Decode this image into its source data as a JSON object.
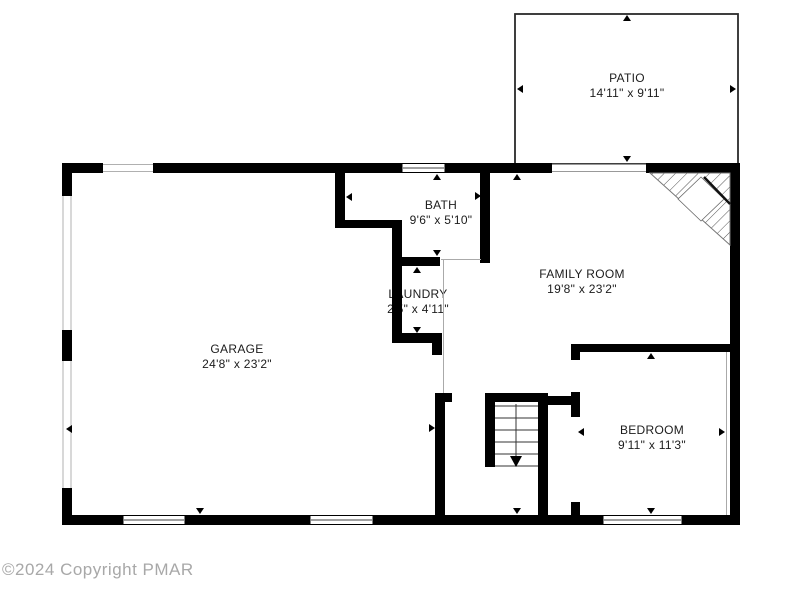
{
  "floorplan": {
    "rooms": [
      {
        "id": "patio",
        "label": "PATIO",
        "dims": "14'11\" x 9'11\""
      },
      {
        "id": "bath",
        "label": "BATH",
        "dims": "9'6\" x 5'10\""
      },
      {
        "id": "laundry",
        "label": "LAUNDRY",
        "dims": "2'5\" x 4'11\""
      },
      {
        "id": "garage",
        "label": "GARAGE",
        "dims": "24'8\" x 23'2\""
      },
      {
        "id": "family_room",
        "label": "FAMILY ROOM",
        "dims": "19'8\" x 23'2\""
      },
      {
        "id": "bedroom",
        "label": "BEDROOM",
        "dims": "9'11\" x 11'3\""
      }
    ],
    "copyright": "©2024 Copyright PMAR",
    "colors": {
      "wall": "#000000",
      "window_line": "#b0b0b0",
      "opening_line": "#aaaaaa",
      "text": "#1c1c1c",
      "copyright_text": "#a8a8a8",
      "background": "#ffffff"
    }
  }
}
